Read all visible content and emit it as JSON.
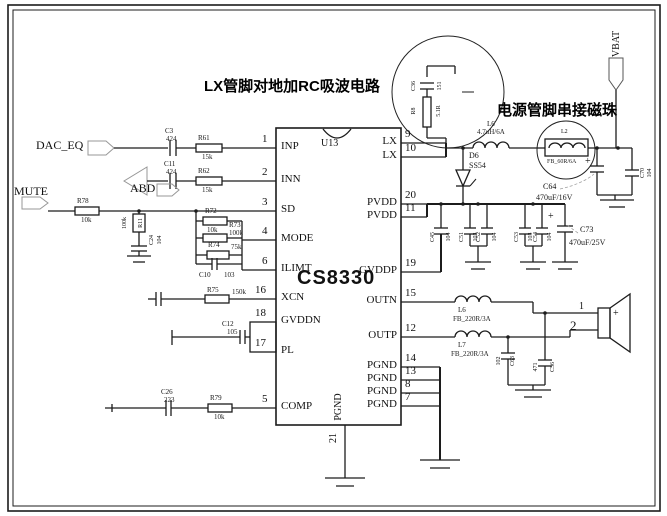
{
  "annotations": {
    "snubber_note": "LX管脚对地加RC吸波电路",
    "bead_note": "电源管脚串接磁珠"
  },
  "nets": {
    "dac_eq": "DAC_EQ",
    "mute": "MUTE",
    "abd": "ABD",
    "vbat": "VBAT"
  },
  "ic": {
    "ref": "U13",
    "part": "CS8330",
    "left_pins": [
      {
        "n": "1",
        "label": "INP"
      },
      {
        "n": "2",
        "label": "INN"
      },
      {
        "n": "3",
        "label": "SD"
      },
      {
        "n": "4",
        "label": "MODE"
      },
      {
        "n": "6",
        "label": "ILIMT"
      },
      {
        "n": "16",
        "label": "XCN"
      },
      {
        "n": "18",
        "label": "GVDDN"
      },
      {
        "n": "17",
        "label": "PL"
      },
      {
        "n": "5",
        "label": "COMP"
      }
    ],
    "right_pins": [
      {
        "n": "9",
        "label": "LX"
      },
      {
        "n": "10",
        "label": "LX"
      },
      {
        "n": "20",
        "label": "PVDD"
      },
      {
        "n": "11",
        "label": "PVDD"
      },
      {
        "n": "19",
        "label": "GVDDP"
      },
      {
        "n": "15",
        "label": "OUTN"
      },
      {
        "n": "12",
        "label": "OUTP"
      },
      {
        "n": "14",
        "label": "PGND"
      },
      {
        "n": "13",
        "label": "PGND"
      },
      {
        "n": "8",
        "label": "PGND"
      },
      {
        "n": "7",
        "label": "PGND"
      }
    ],
    "bottom_pin": {
      "n": "21",
      "label": "PGND"
    }
  },
  "components": {
    "c3": {
      "ref": "C3",
      "value": "424"
    },
    "r61": {
      "ref": "R61",
      "value": "15k"
    },
    "c11": {
      "ref": "C11",
      "value": "424"
    },
    "r62": {
      "ref": "R62",
      "value": "15k"
    },
    "r78": {
      "ref": "R78",
      "value": "10k"
    },
    "r11": {
      "ref": "R11",
      "value": "100k"
    },
    "c24": {
      "ref": "C24",
      "value": "104"
    },
    "r72": {
      "ref": "R72",
      "value": "10k"
    },
    "r73": {
      "ref": "R73",
      "value": "100k"
    },
    "r74": {
      "ref": "R74",
      "value": "75k"
    },
    "c10": {
      "ref": "C10",
      "value": "103"
    },
    "r75": {
      "ref": "R75",
      "value": "150k"
    },
    "c12": {
      "ref": "C12",
      "value": "105"
    },
    "c26": {
      "ref": "C26",
      "value": "223"
    },
    "r79": {
      "ref": "R79",
      "value": "10k"
    },
    "c36": {
      "ref": "C36",
      "value": "151"
    },
    "r8": {
      "ref": "R8",
      "value": "5.1R"
    },
    "l6_ind": {
      "ref": "L6",
      "value": "4.7uH/6A"
    },
    "d6": {
      "ref": "D6",
      "value": "SS54"
    },
    "l2": {
      "ref": "L2",
      "value": "FB_60R/6A"
    },
    "c64": {
      "ref": "C64",
      "value": "470uF/16V",
      "plus": "+"
    },
    "c70": {
      "ref": "C70",
      "value": "104"
    },
    "c45": {
      "ref": "C45",
      "value": "104"
    },
    "c51": {
      "ref": "C51",
      "value": "103"
    },
    "c52": {
      "ref": "C52",
      "value": "104"
    },
    "c53": {
      "ref": "C53",
      "value": "103"
    },
    "c54": {
      "ref": "C54",
      "value": "104"
    },
    "c73": {
      "ref": "C73",
      "value": "470uF/25V",
      "plus": "+"
    },
    "l6_fb": {
      "ref": "L6",
      "value": "FB_220R/3A"
    },
    "l7_fb": {
      "ref": "L7",
      "value": "FB_220R/3A"
    },
    "c63": {
      "ref": "C63",
      "value": "102"
    },
    "c56": {
      "ref": "C56",
      "value": "471"
    }
  },
  "speaker": {
    "plus": "+",
    "terminal_1": "1",
    "terminal_2": "2"
  }
}
